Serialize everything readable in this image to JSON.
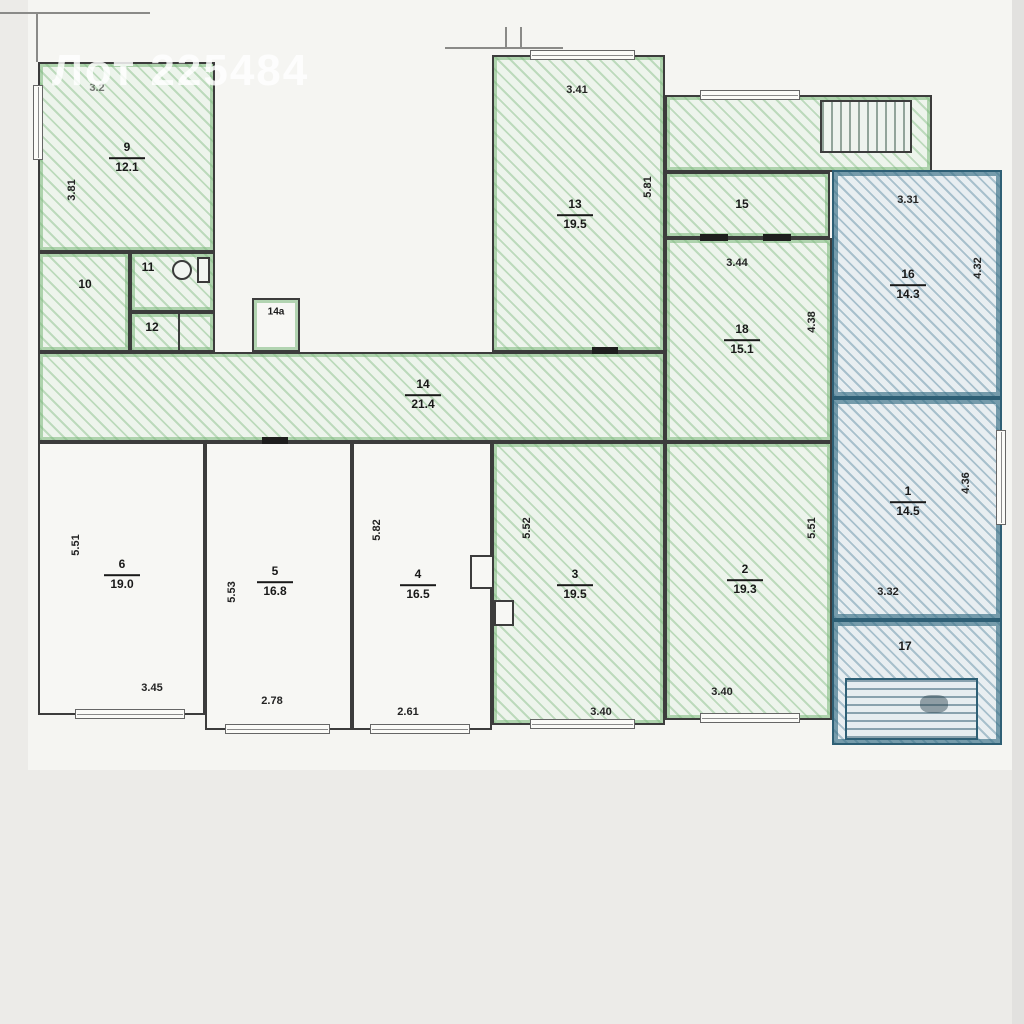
{
  "watermark": "Лот 225484",
  "colors": {
    "highlight_green": "#7ab87a",
    "highlight_blue": "#2e6f86",
    "wall": "#3c3c3c",
    "paper": "#f5f5f2"
  },
  "rooms": {
    "9": {
      "num": "9",
      "area": "12.1"
    },
    "10": {
      "num": "10"
    },
    "11": {
      "num": "11"
    },
    "12": {
      "num": "12"
    },
    "14a": {
      "num": "14а"
    },
    "13": {
      "num": "13",
      "area": "19.5"
    },
    "15": {
      "num": "15"
    },
    "18": {
      "num": "18",
      "area": "15.1"
    },
    "16": {
      "num": "16",
      "area": "14.3"
    },
    "14": {
      "num": "14",
      "area": "21.4"
    },
    "6": {
      "num": "6",
      "area": "19.0"
    },
    "5": {
      "num": "5",
      "area": "16.8"
    },
    "4": {
      "num": "4",
      "area": "16.5"
    },
    "3": {
      "num": "3",
      "area": "19.5"
    },
    "2": {
      "num": "2",
      "area": "19.3"
    },
    "1": {
      "num": "1",
      "area": "14.5"
    },
    "17": {
      "num": "17"
    }
  },
  "dims": {
    "r9_top": "3.2",
    "r9_left": "3.81",
    "r13_top": "3.41",
    "r13_right": "5.81",
    "r18_top": "3.44",
    "r18_right": "4.38",
    "r16_top": "3.31",
    "r16_right": "4.32",
    "r6_left": "5.51",
    "r6_bottom": "3.45",
    "r5_left": "5.53",
    "r5_bottom": "2.78",
    "r4_left": "5.82",
    "r4_bottom": "2.61",
    "r3_left": "5.52",
    "r3_bottom": "3.40",
    "r2_right": "5.51",
    "r2_bottom": "3.40",
    "r1_right": "4.36",
    "r1_bottom": "3.32"
  }
}
